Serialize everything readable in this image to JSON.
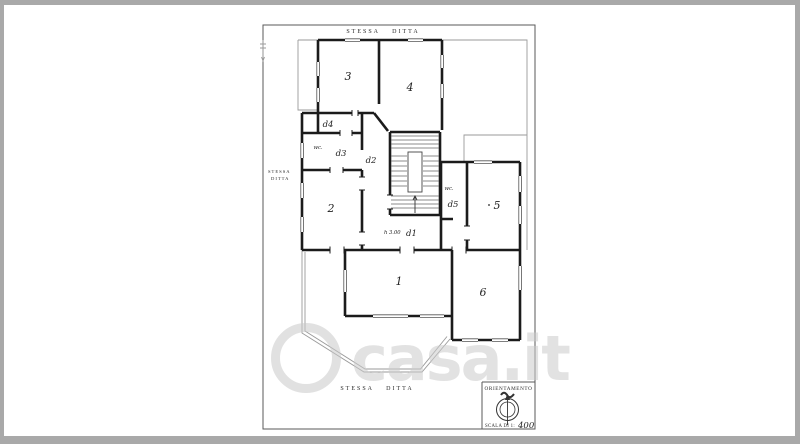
{
  "watermark": {
    "brand": "casa.it"
  },
  "plan": {
    "boundary": {
      "top": "STESSA DITTA",
      "left_line1": "STESSA",
      "left_line2": "DITTA",
      "bottom": "STESSA DITTA"
    },
    "rooms": {
      "r1": "1",
      "r2": "2",
      "r3": "3",
      "r4": "4",
      "r5": "5",
      "r6": "6",
      "d1": "d1",
      "d2": "d2",
      "d3": "d3",
      "d4": "d4",
      "d5": "d5",
      "wc_a": "wc.",
      "wc_b": "wc.",
      "height_note": "h 3.00"
    },
    "legend": {
      "orientation_title": "ORIENTAMENTO",
      "scale_label": "SCALA DI 1:",
      "scale_value": "400"
    }
  }
}
